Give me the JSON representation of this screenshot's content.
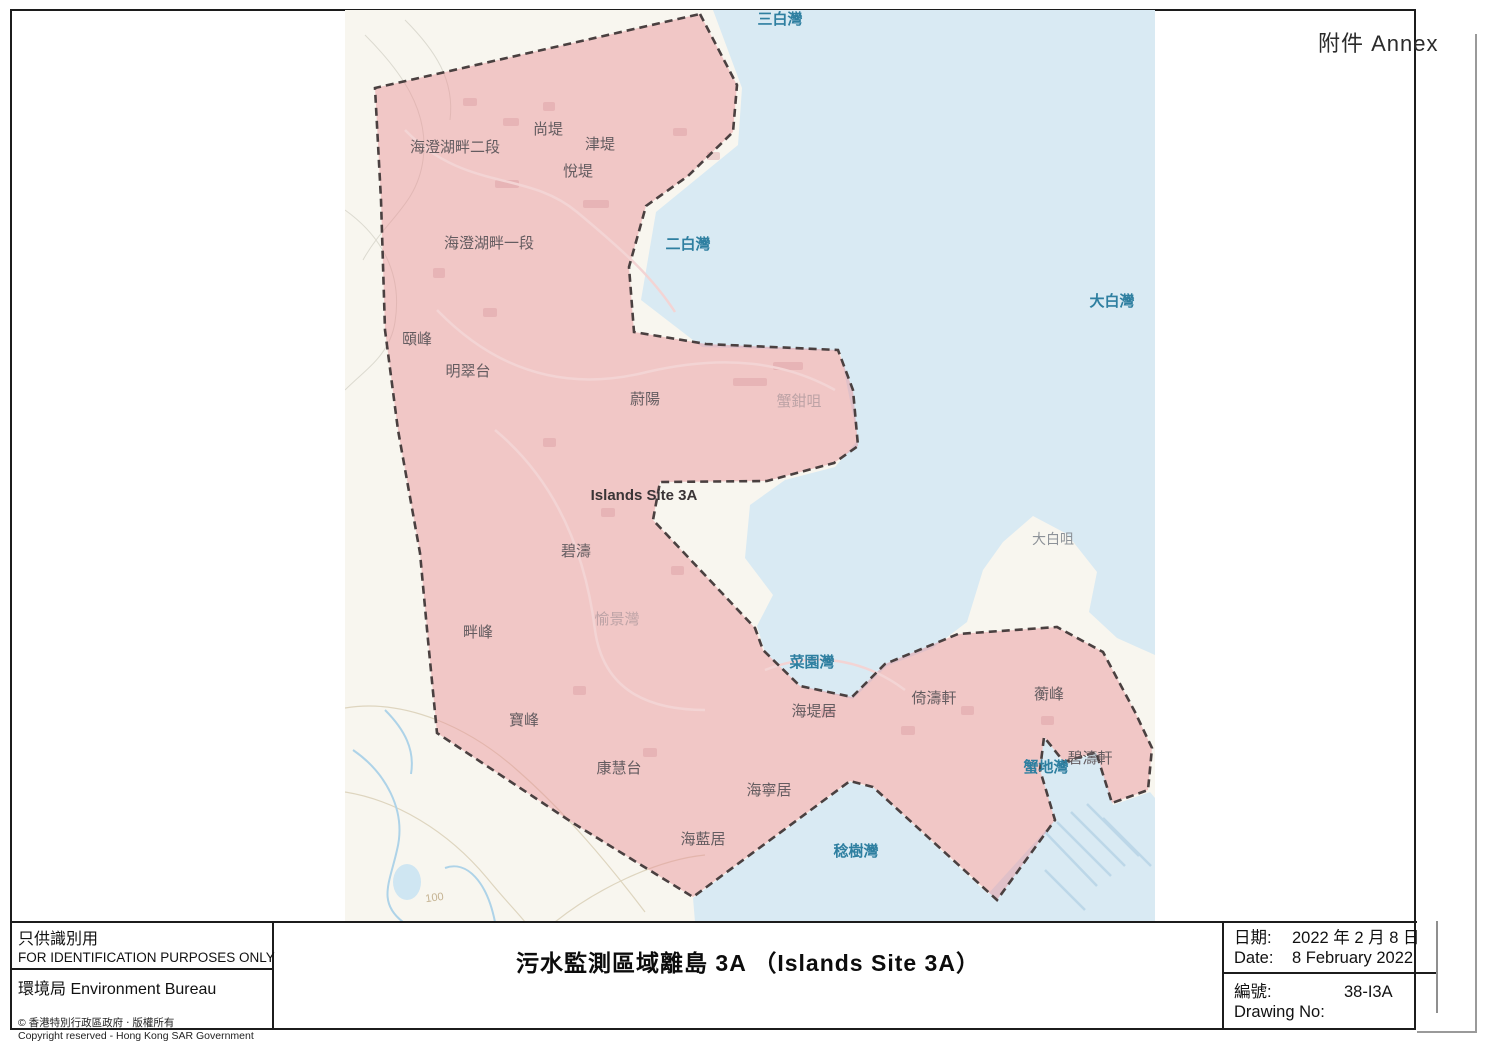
{
  "annex": "附件 Annex",
  "map": {
    "labels": [
      "三白灣",
      "尚堤",
      "海澄湖畔二段",
      "津堤",
      "悅堤",
      "海澄湖畔一段",
      "二白灣",
      "大白灣",
      "頤峰",
      "明翠台",
      "蔚陽",
      "蟹鉗咀",
      "Islands Site 3A",
      "碧濤",
      "大白咀",
      "愉景灣",
      "畔峰",
      "菜園灣",
      "海堤居",
      "倚濤軒",
      "蘅峰",
      "寶峰",
      "碧濤軒",
      "蟹地灣",
      "康慧台",
      "海寧居",
      "海藍居",
      "稔樹灣",
      "100"
    ],
    "colors": {
      "zone_fill": "#e98f94",
      "zone_boundary": "#4a4040",
      "sea": "#d9eaf3",
      "land": "#f8f6ef",
      "sea_label": "#2e7fa0"
    }
  },
  "footer": {
    "id_zh": "只供識別用",
    "id_en": "FOR IDENTIFICATION PURPOSES ONLY",
    "bureau": "環境局  Environment Bureau",
    "copyright_zh": "© 香港特別行政區政府 ‧ 版權所有",
    "copyright_en": "Copyright reserved - Hong Kong SAR Government",
    "title": "污水監測區域離島 3A （Islands Site 3A）",
    "date_label_zh": "日期:",
    "date_value_zh": "2022 年 2 月 8 日",
    "date_label_en": "Date:",
    "date_value_en": "8 February 2022",
    "no_label_zh": "編號:",
    "no_value": "38-I3A",
    "no_label_en": "Drawing No:"
  }
}
